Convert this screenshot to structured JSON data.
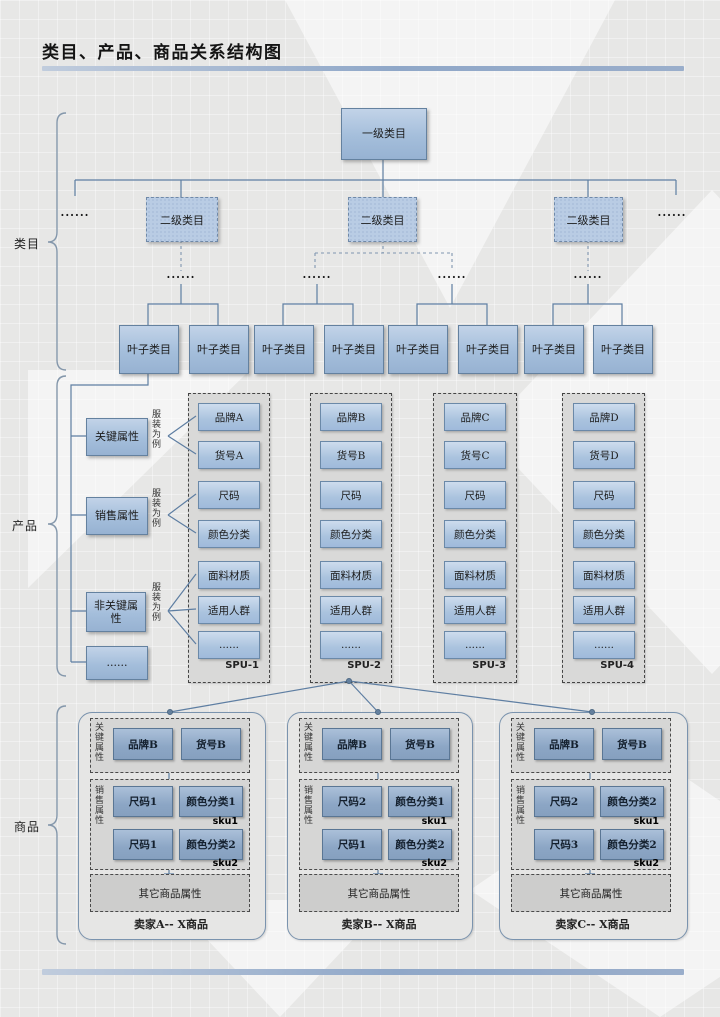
{
  "title": "类目、产品、商品关系结构图",
  "section_labels": {
    "category": "类目",
    "product": "产品",
    "commodity": "商品"
  },
  "category": {
    "root_label": "一级类目",
    "level2_labels": [
      "二级类目",
      "二级类目",
      "二级类目"
    ],
    "leaf_labels": [
      "叶子类目",
      "叶子类目",
      "叶子类目",
      "叶子类目",
      "叶子类目",
      "叶子类目",
      "叶子类目",
      "叶子类目"
    ],
    "ellipsis_left": "......",
    "ellipsis_right": "......",
    "branch_ellipsis": [
      "......",
      "......",
      "......",
      "......"
    ]
  },
  "product": {
    "attribute_boxes": [
      "关键属性",
      "销售属性",
      "非关键属性",
      "......"
    ],
    "attribute_notes": [
      "服装为例",
      "服装为例",
      "服装为例"
    ],
    "spu_columns": [
      {
        "footer": "SPU-1",
        "items": [
          "品牌A",
          "货号A",
          "尺码",
          "颜色分类",
          "面料材质",
          "适用人群",
          "......"
        ]
      },
      {
        "footer": "SPU-2",
        "items": [
          "品牌B",
          "货号B",
          "尺码",
          "颜色分类",
          "面料材质",
          "适用人群",
          "......"
        ]
      },
      {
        "footer": "SPU-3",
        "items": [
          "品牌C",
          "货号C",
          "尺码",
          "颜色分类",
          "面料材质",
          "适用人群",
          "......"
        ]
      },
      {
        "footer": "SPU-4",
        "items": [
          "品牌D",
          "货号D",
          "尺码",
          "颜色分类",
          "面料材质",
          "适用人群",
          "......"
        ]
      }
    ]
  },
  "commodity": {
    "sellers": [
      {
        "footer": "卖家A-- X商品",
        "key_label": "关键属性",
        "key_items": [
          "品牌B",
          "货号B"
        ],
        "sales_label": "销售属性",
        "sku_rows": [
          {
            "size": "尺码1",
            "color": "颜色分类1",
            "tag": "sku1"
          },
          {
            "size": "尺码1",
            "color": "颜色分类2",
            "tag": "sku2"
          }
        ],
        "other_label": "其它商品属性"
      },
      {
        "footer": "卖家B-- X商品",
        "key_label": "关键属性",
        "key_items": [
          "品牌B",
          "货号B"
        ],
        "sales_label": "销售属性",
        "sku_rows": [
          {
            "size": "尺码2",
            "color": "颜色分类1",
            "tag": "sku1"
          },
          {
            "size": "尺码1",
            "color": "颜色分类2",
            "tag": "sku2"
          }
        ],
        "other_label": "其它商品属性"
      },
      {
        "footer": "卖家C-- X商品",
        "key_label": "关键属性",
        "key_items": [
          "品牌B",
          "货号B"
        ],
        "sales_label": "销售属性",
        "sku_rows": [
          {
            "size": "尺码2",
            "color": "颜色分类2",
            "tag": "sku1"
          },
          {
            "size": "尺码3",
            "color": "颜色分类2",
            "tag": "sku2"
          }
        ],
        "other_label": "其它商品属性"
      }
    ]
  },
  "colors": {
    "accent_bar": "#9db3d2",
    "node_fill": "#a9c2de",
    "node_border": "#64819f",
    "connector": "#5f7fa3"
  }
}
